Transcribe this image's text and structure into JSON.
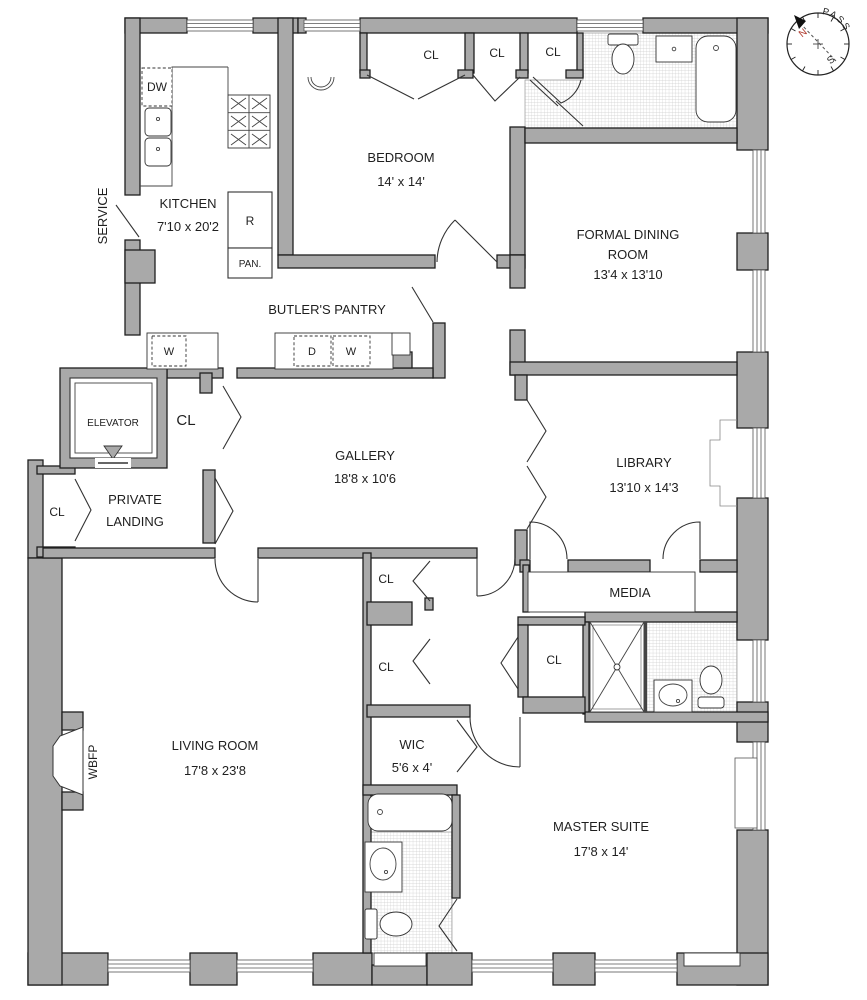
{
  "colors": {
    "wall": "#a9a9a9",
    "outline": "#1f1f1f",
    "text": "#1f1f1f",
    "north": "#b03a2e",
    "hatch": "#cccccc"
  },
  "rooms": {
    "service": {
      "name": "SERVICE"
    },
    "kitchen": {
      "name": "KITCHEN",
      "dims": "7'10 x 20'2"
    },
    "bedroom": {
      "name": "BEDROOM",
      "dims": "14' x 14'"
    },
    "dining": {
      "line1": "FORMAL DINING",
      "line2": "ROOM",
      "dims": "13'4 x 13'10"
    },
    "butlers_pantry": {
      "name": "BUTLER'S PANTRY"
    },
    "elevator": {
      "name": "ELEVATOR"
    },
    "private_landing": {
      "line1": "PRIVATE",
      "line2": "LANDING"
    },
    "gallery": {
      "name": "GALLERY",
      "dims": "18'8 x 10'6"
    },
    "library": {
      "name": "LIBRARY",
      "dims": "13'10 x 14'3"
    },
    "media": {
      "name": "MEDIA"
    },
    "living_room": {
      "name": "LIVING ROOM",
      "dims": "17'8 x 23'8"
    },
    "wic": {
      "name": "WIC",
      "dims": "5'6 x 4'"
    },
    "master_suite": {
      "name": "MASTER SUITE",
      "dims": "17'8 x 14'"
    }
  },
  "fixtures": {
    "closet": "CL",
    "dishwasher": "DW",
    "refrigerator": "R",
    "pantry_cabinet": "PAN.",
    "washer": "W",
    "dryer": "D",
    "wood_burning_fireplace": "WBFP"
  },
  "compass": {
    "word": "COMPASS",
    "north": "N",
    "south": "S"
  }
}
